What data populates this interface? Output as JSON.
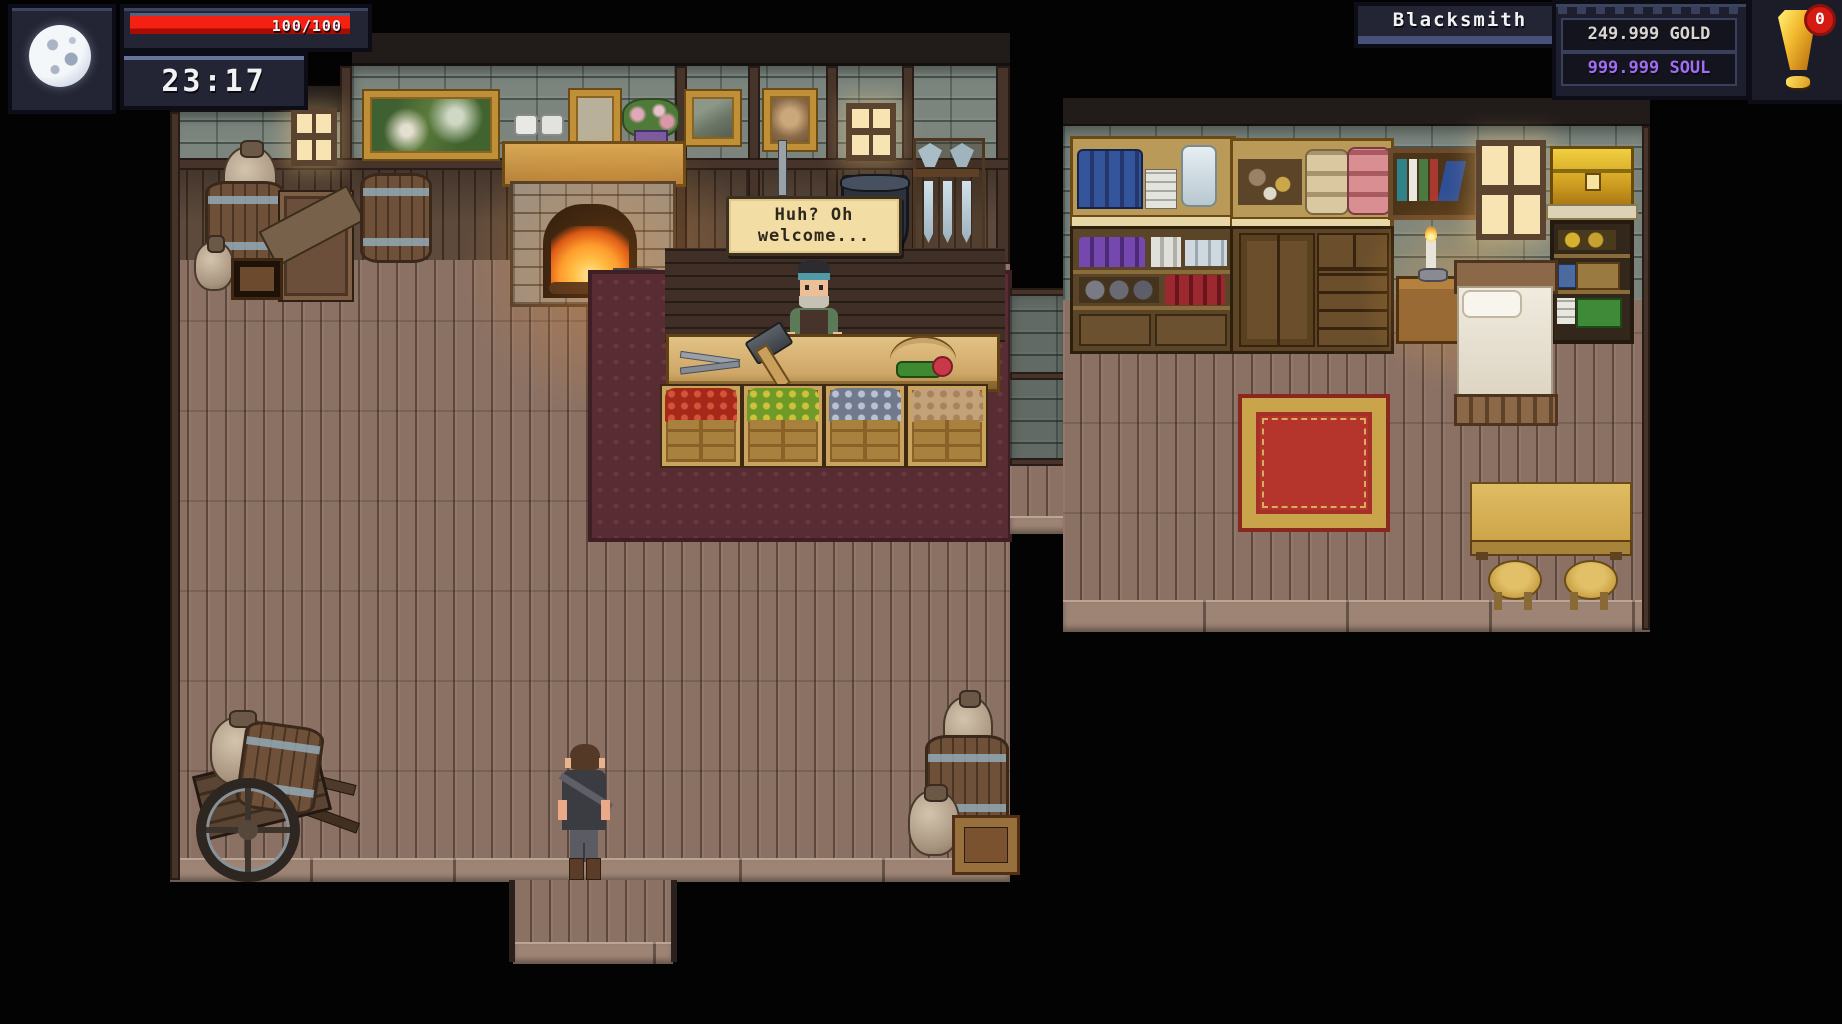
{
  "hud": {
    "time": "23:17",
    "health": {
      "label": "100/100",
      "bar_color": "#ee1307",
      "bar_fill_ratio": 1
    },
    "location_label": "Blacksmith",
    "currencies": {
      "gold": {
        "label": "249.999 GOLD",
        "color": "#d9d6cf"
      },
      "soul": {
        "label": "999.999 SOUL",
        "color": "#a06cf0"
      }
    },
    "notification": {
      "badge_count": "0",
      "badge_color": "#d41a12",
      "icon": "exclamation-icon",
      "icon_color": "#f0b62c"
    },
    "moon_icon": "full-moon"
  },
  "dialogue": {
    "lines": [
      "Huh? Oh",
      "welcome..."
    ],
    "bg": "#f2dda4",
    "text_color": "#2f281d"
  },
  "scene": {
    "npc": "blacksmith-shopkeeper",
    "player": "player-character",
    "counter_items": [
      "tongs",
      "smith-hammer",
      "bow",
      "herb-bundle"
    ],
    "shop_crates": [
      "red-produce",
      "green-produce",
      "ore-chunks",
      "roots"
    ],
    "furniture": [
      "fireplace",
      "anvil",
      "mantel",
      "landscape-painting",
      "portraits",
      "windows",
      "weapon-rack",
      "barrels",
      "crates",
      "jugs",
      "hand-cart",
      "potion-shelves",
      "cloth-cabinet",
      "bookshelf",
      "candle-nightstand",
      "golden-chest",
      "bed",
      "red-gold-rug",
      "maroon-rug",
      "dining-table",
      "stools",
      "bucket"
    ]
  }
}
